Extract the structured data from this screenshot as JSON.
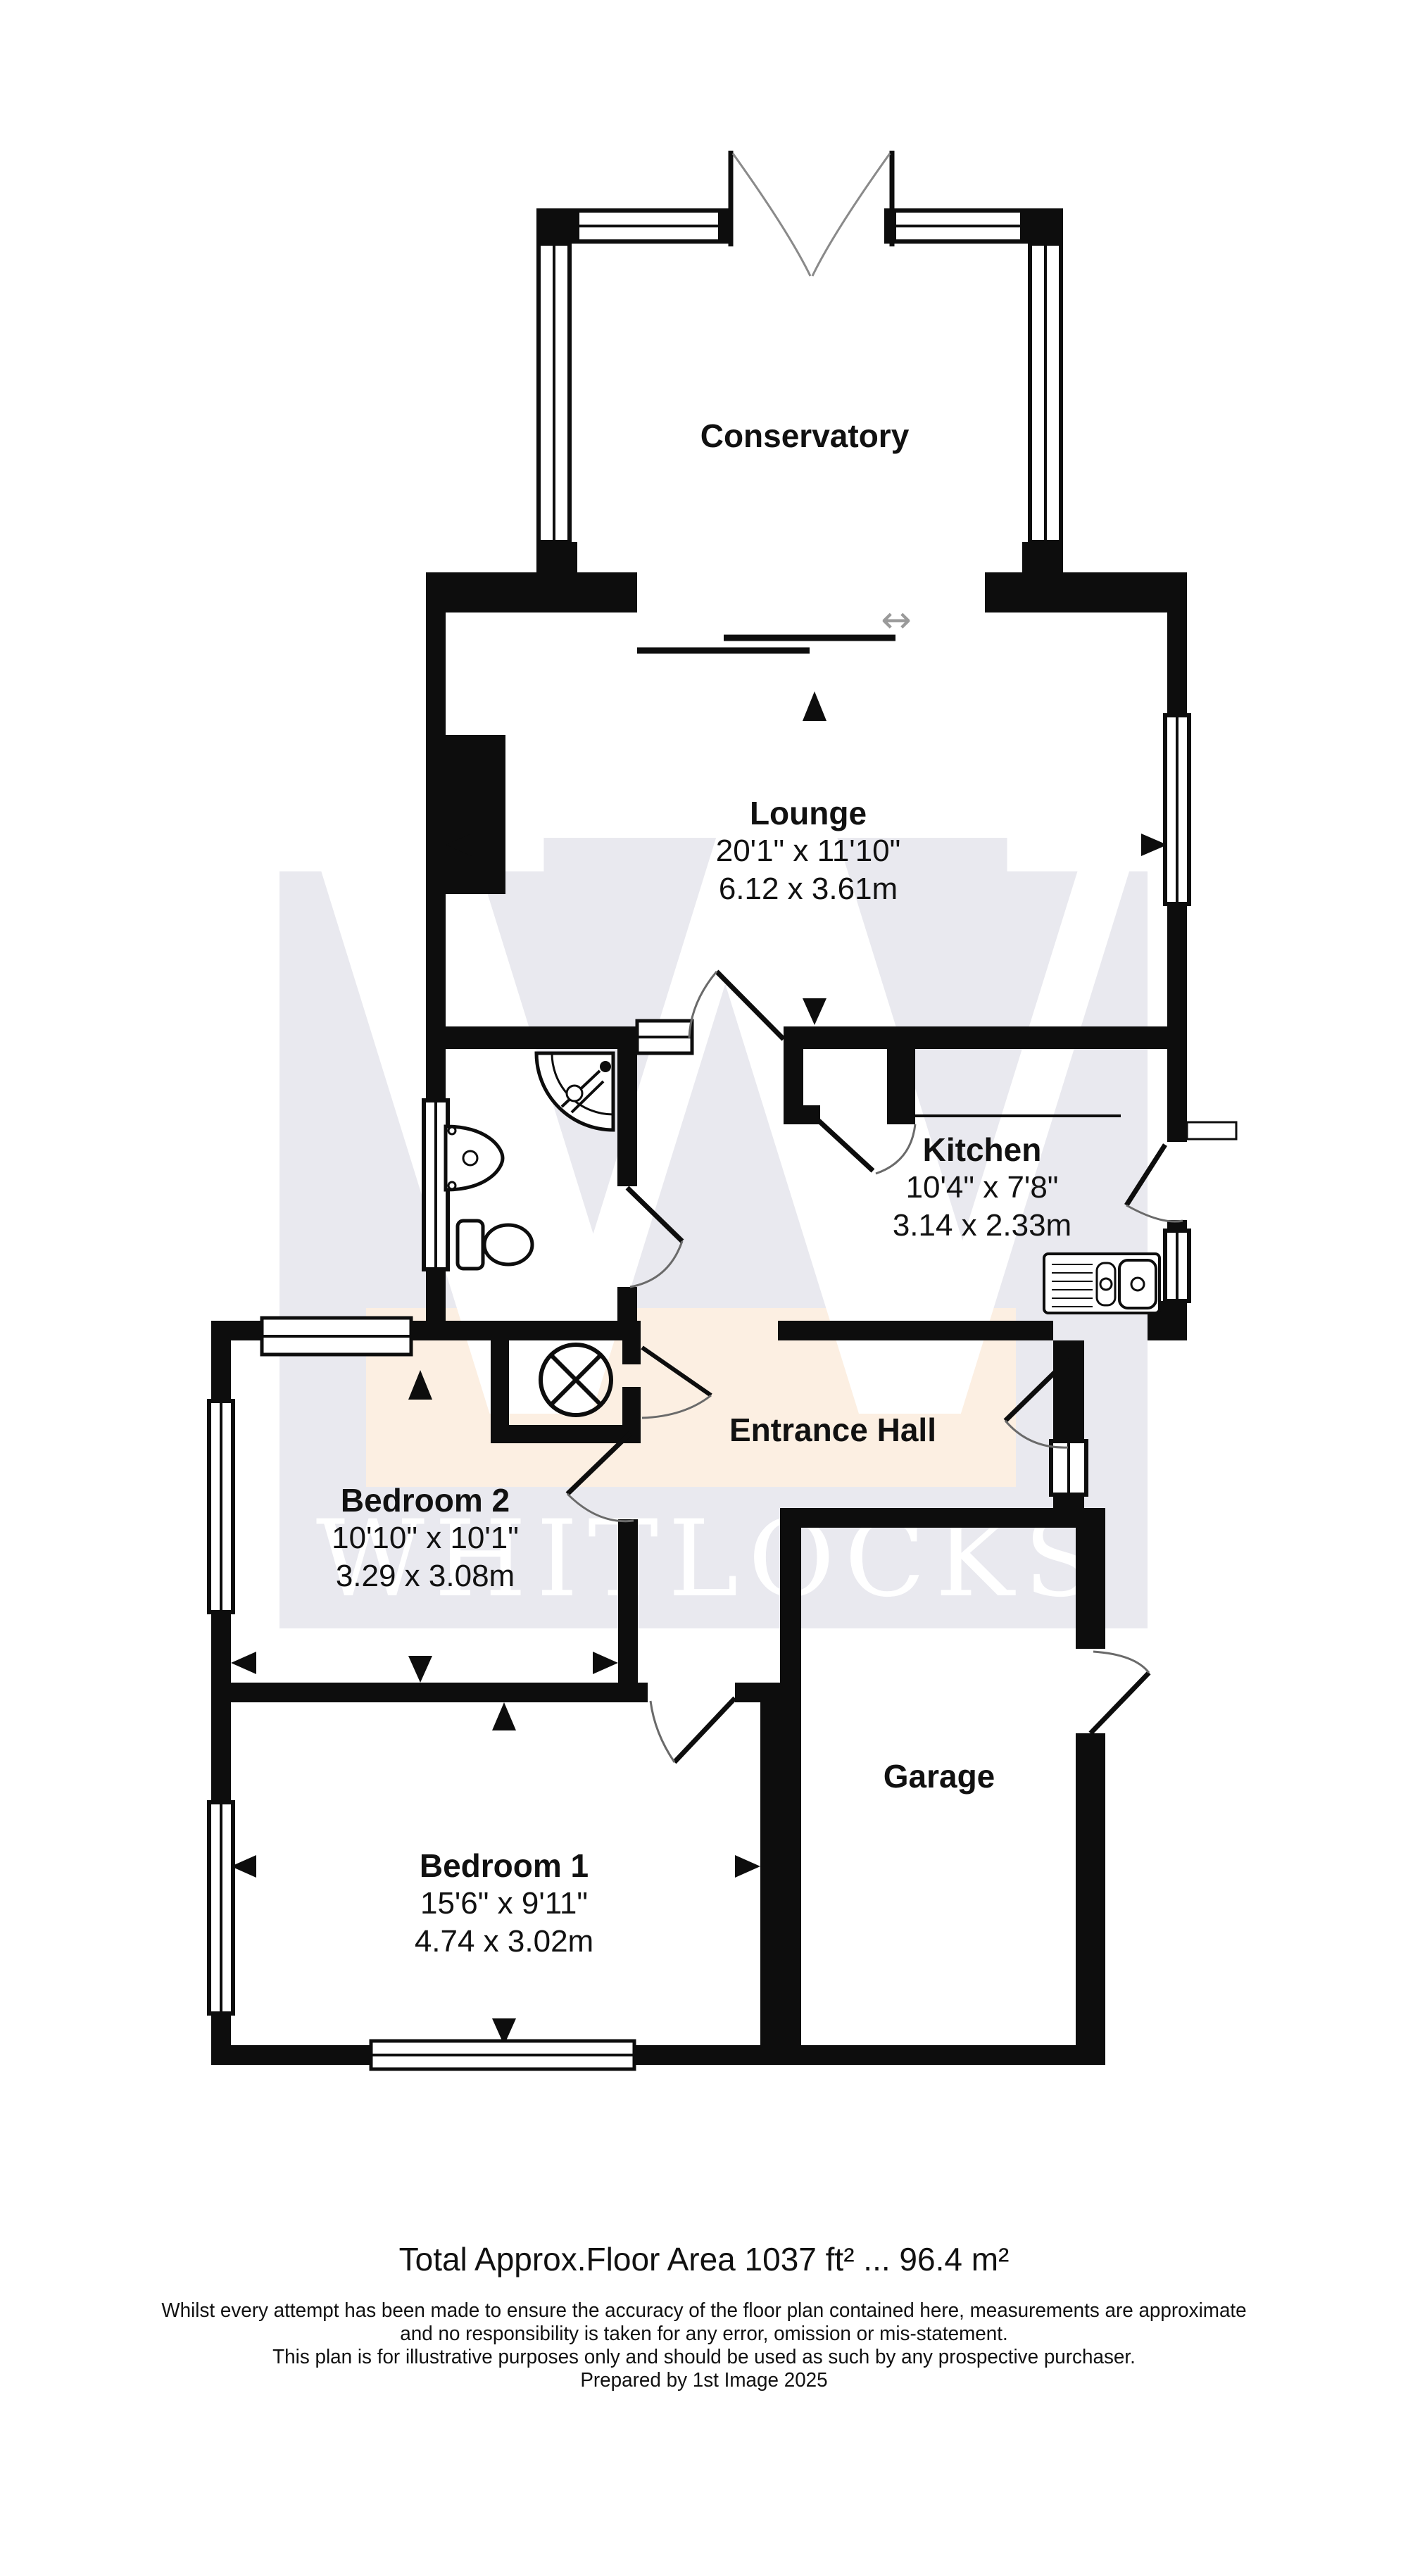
{
  "watermark": {
    "letter": "W",
    "name": "WHITLOCKS",
    "square_color": "#e9e9ef",
    "band_color": "#fcefe2",
    "text_color": "#ffffff"
  },
  "rooms": [
    {
      "id": "conservatory",
      "name": "Conservatory",
      "dims_imperial": "",
      "dims_metric": ""
    },
    {
      "id": "lounge",
      "name": "Lounge",
      "dims_imperial": "20'1\" x 11'10\"",
      "dims_metric": "6.12 x 3.61m"
    },
    {
      "id": "kitchen",
      "name": "Kitchen",
      "dims_imperial": "10'4\" x 7'8\"",
      "dims_metric": "3.14 x 2.33m"
    },
    {
      "id": "entrance_hall",
      "name": "Entrance Hall",
      "dims_imperial": "",
      "dims_metric": ""
    },
    {
      "id": "bedroom2",
      "name": "Bedroom 2",
      "dims_imperial": "10'10\" x 10'1\"",
      "dims_metric": "3.29 x 3.08m"
    },
    {
      "id": "bedroom1",
      "name": "Bedroom 1",
      "dims_imperial": "15'6\" x 9'11\"",
      "dims_metric": "4.74 x 3.02m"
    },
    {
      "id": "garage",
      "name": "Garage",
      "dims_imperial": "",
      "dims_metric": ""
    }
  ],
  "symbols": {
    "sliding_door_arrow": "↔"
  },
  "colors": {
    "wall": "#0d0d0d",
    "door_arc": "#6a6a6a",
    "watermark_gray": "#e9e9ef",
    "watermark_peach": "#fcefe2"
  },
  "footer": {
    "total_area": "Total Approx.Floor Area 1037 ft² ... 96.4 m²",
    "disclaimer_line1": "Whilst every attempt has been made to ensure the accuracy of the floor plan contained here, measurements are approximate",
    "disclaimer_line2": "and no responsibility is taken for any error, omission or mis-statement.",
    "disclaimer_line3": "This plan is for illustrative purposes only and should be used as such by any prospective purchaser.",
    "disclaimer_line4": "Prepared by 1st Image 2025"
  }
}
